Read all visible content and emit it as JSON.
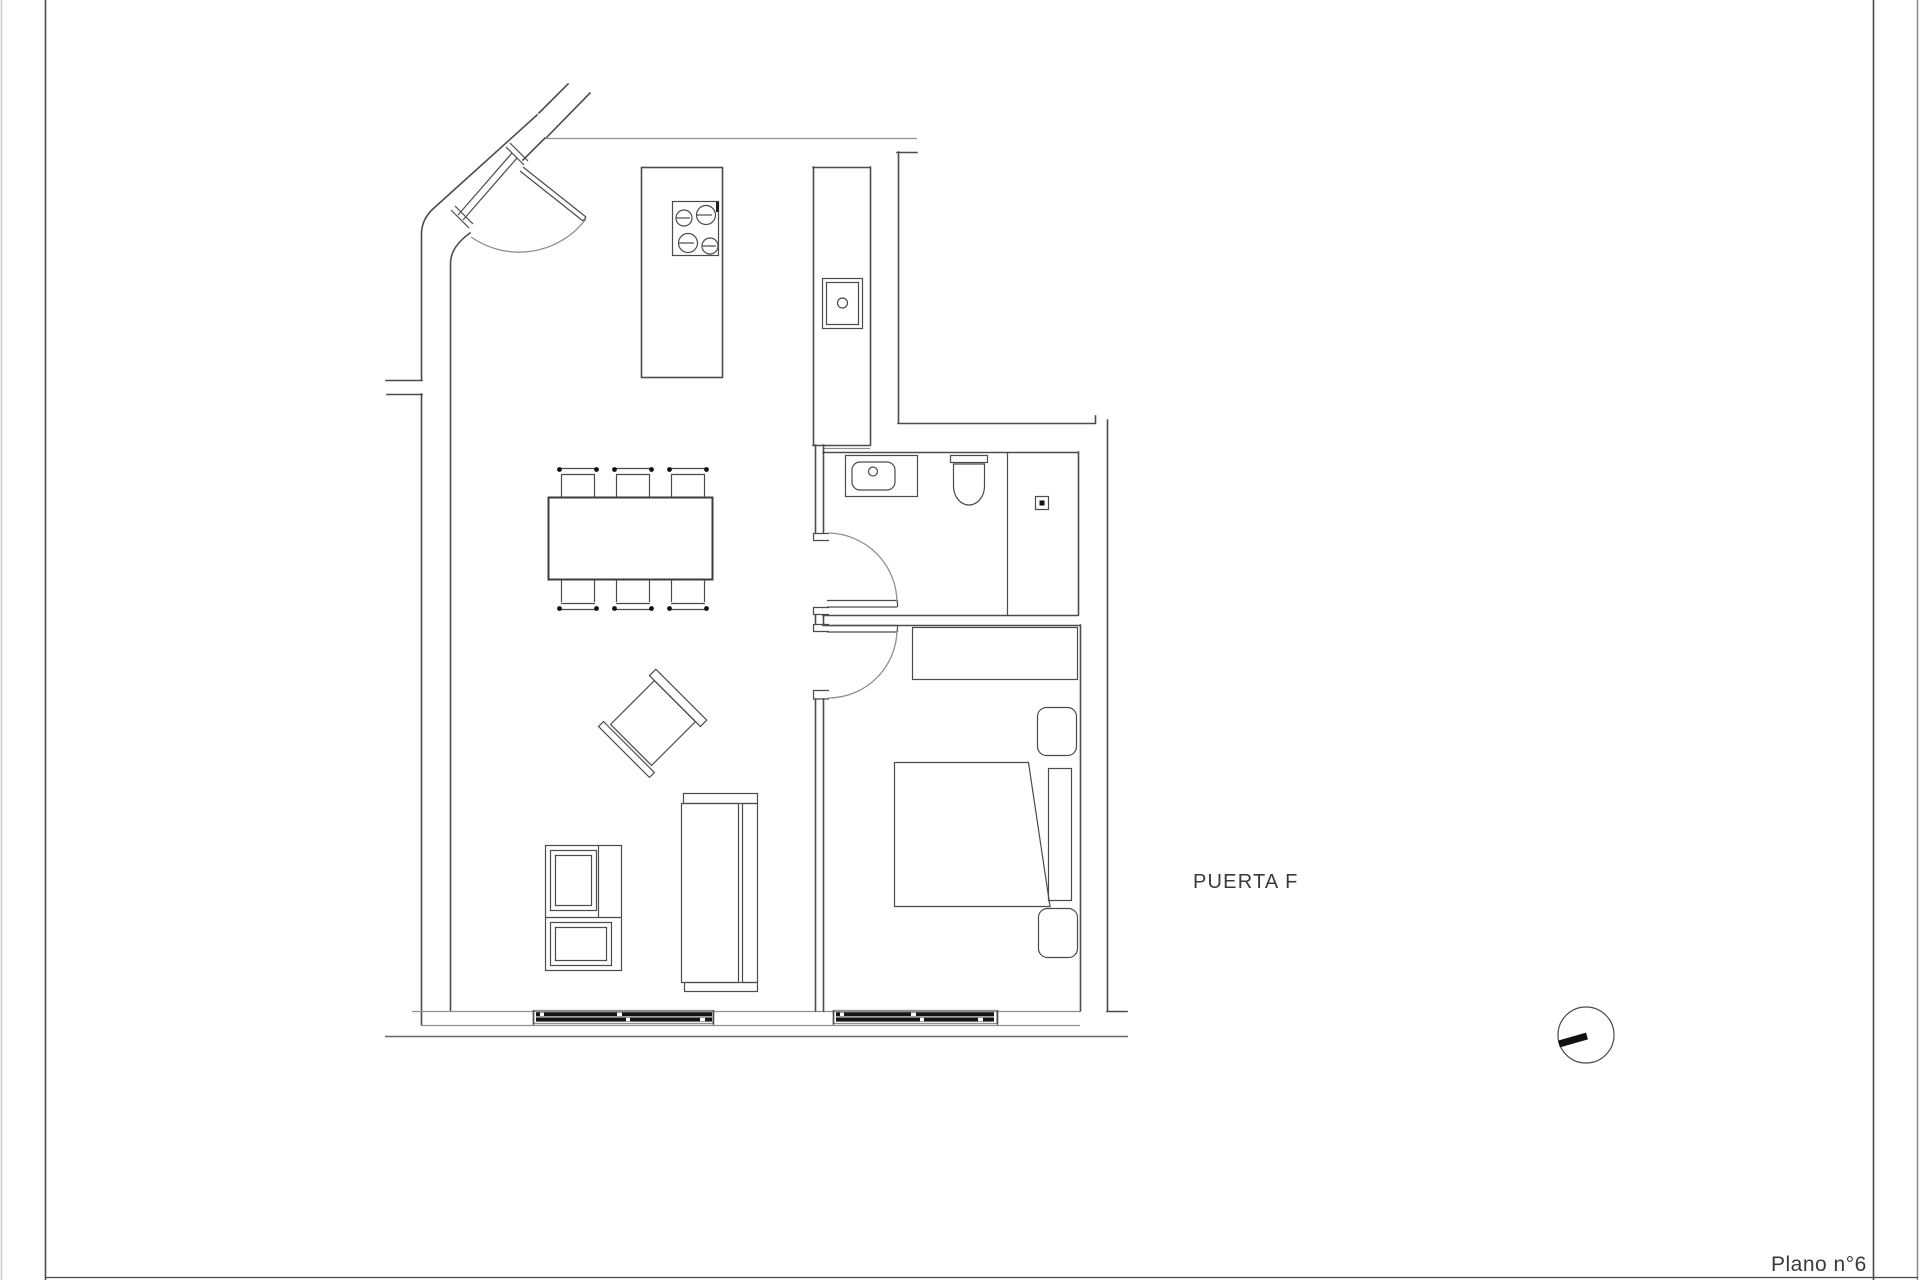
{
  "theme": {
    "background": "#ffffff",
    "line": "#4b4b4b",
    "light_line": "#8f8f8f",
    "window_fill": "#161616",
    "text_color": "#3a3a3a"
  },
  "labels": {
    "door": "PUERTA F",
    "plan_number": "Plano n°6"
  }
}
